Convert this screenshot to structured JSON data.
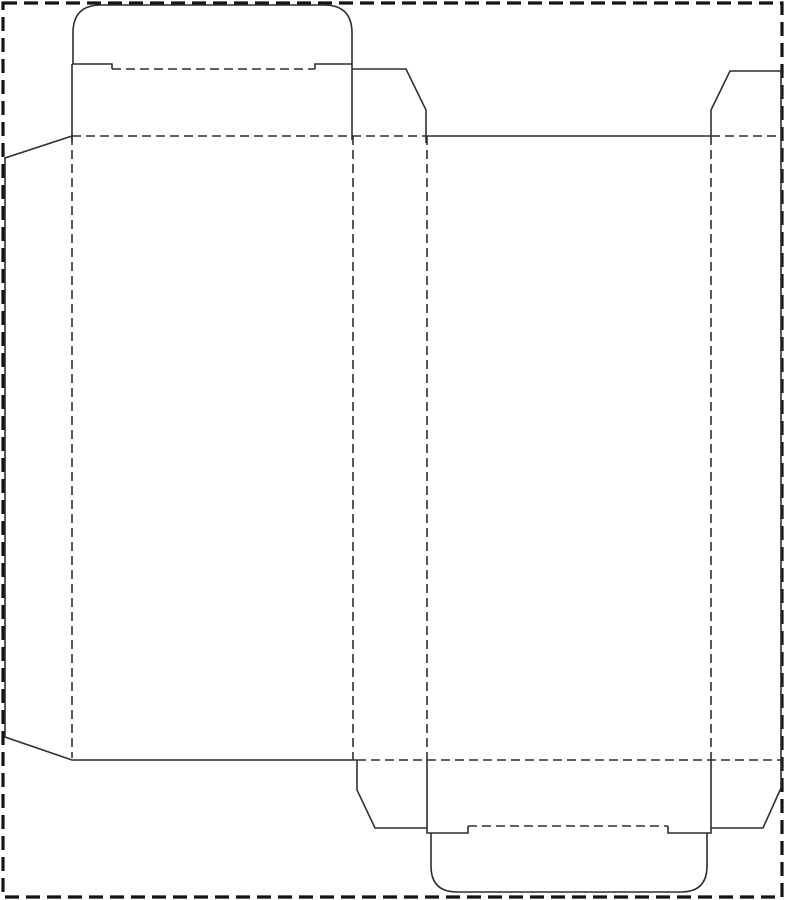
{
  "canvas": {
    "width": 785,
    "height": 900,
    "background": "#ffffff"
  },
  "styles": {
    "page-border": {
      "stroke": "#141414",
      "strokeWidth": 3.2,
      "dash": "14 7"
    },
    "cut": {
      "stroke": "#2f2f2f",
      "strokeWidth": 1.6,
      "dash": ""
    },
    "fold": {
      "stroke": "#2f2f2f",
      "strokeWidth": 1.6,
      "dash": "9 5"
    }
  },
  "dieline": {
    "kind": "tuck-end carton dieline",
    "paths": [
      {
        "name": "page-border",
        "style": "page-border",
        "d": "M 3 3 H 782 V 897 H 3 Z"
      },
      {
        "name": "top-tuck-flap-outline",
        "style": "cut",
        "d": "M 73 64 V 33 Q 73 5 101 5 H 324 Q 352 5 352 33 V 64"
      },
      {
        "name": "top-tuck-left-shoulder",
        "style": "cut",
        "d": "M 72 64 H 112 V 69"
      },
      {
        "name": "top-tuck-right-shoulder",
        "style": "cut",
        "d": "M 315 69 V 64 H 352"
      },
      {
        "name": "top-tuck-crease",
        "style": "fold",
        "d": "M 112 69 H 315"
      },
      {
        "name": "top-panel-left-edge",
        "style": "cut",
        "d": "M 72 64 V 140"
      },
      {
        "name": "top-panel-right-edge",
        "style": "cut",
        "d": "M 352 64 V 140"
      },
      {
        "name": "top-dust-flap-left-outline",
        "style": "cut",
        "d": "M 352 69 H 406 L 426 110 V 143"
      },
      {
        "name": "top-dust-flap-right-outline",
        "style": "cut",
        "d": "M 711 110 L 730 71 H 781"
      },
      {
        "name": "top-dust-flap-right-edge",
        "style": "cut",
        "d": "M 711 110 V 136"
      },
      {
        "name": "top-fold-line-left",
        "style": "fold",
        "d": "M 72 136 H 427"
      },
      {
        "name": "back-panel-top-cut-edge",
        "style": "cut",
        "d": "M 427 136 H 711"
      },
      {
        "name": "top-fold-line-right",
        "style": "fold",
        "d": "M 711 136 H 781"
      },
      {
        "name": "glue-flap-outline",
        "style": "cut",
        "d": "M 72 136 L 5 158 V 737 L 72 760"
      },
      {
        "name": "glue-flap-fold",
        "style": "fold",
        "d": "M 72 136 V 758"
      },
      {
        "name": "fold-front-to-side",
        "style": "fold",
        "d": "M 353 136 V 760"
      },
      {
        "name": "fold-side-to-back",
        "style": "fold",
        "d": "M 427 136 V 760"
      },
      {
        "name": "fold-back-to-side",
        "style": "fold",
        "d": "M 711 136 V 760"
      },
      {
        "name": "right-panel-cut-edge",
        "style": "cut",
        "d": "M 781 71 V 788"
      },
      {
        "name": "front-panel-bottom-cut-edge",
        "style": "cut",
        "d": "M 72 760 H 357"
      },
      {
        "name": "bottom-fold-line",
        "style": "fold",
        "d": "M 357 760 H 781"
      },
      {
        "name": "bottom-dust-flap-left-outline",
        "style": "cut",
        "d": "M 357 760 V 790 L 375 828 H 427"
      },
      {
        "name": "bottom-panel-left-shoulder",
        "style": "cut",
        "d": "M 427 760 V 833 H 468 V 826"
      },
      {
        "name": "bottom-panel-right-shoulder",
        "style": "cut",
        "d": "M 668 826 V 833 H 711 V 760"
      },
      {
        "name": "bottom-tuck-crease",
        "style": "fold",
        "d": "M 468 826 H 668"
      },
      {
        "name": "bottom-tuck-flap-outline",
        "style": "cut",
        "d": "M 431 833 V 866 Q 431 892 457 892 H 681 Q 707 892 707 866 V 833"
      },
      {
        "name": "bottom-dust-flap-right-outline",
        "style": "cut",
        "d": "M 711 828 H 763 L 781 788"
      }
    ]
  }
}
